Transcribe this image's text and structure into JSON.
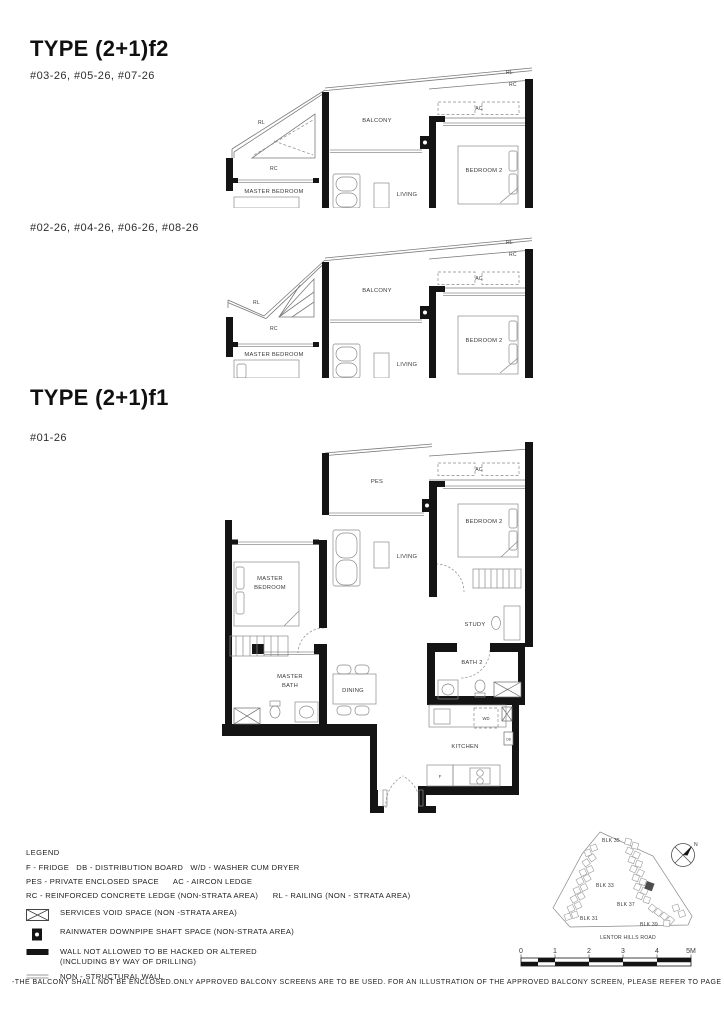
{
  "sections": {
    "f2": {
      "title": "TYPE (2+1)f2",
      "units_a": "#03-26, #05-26, #07-26",
      "units_b": "#02-26, #04-26, #06-26, #08-26"
    },
    "f1": {
      "title": "TYPE (2+1)f1",
      "units": "#01-26"
    }
  },
  "rooms": {
    "balcony": "BALCONY",
    "pes": "PES",
    "ac": "AC",
    "rl": "RL",
    "rc": "RC",
    "master_bedroom": "MASTER BEDROOM",
    "master": "MASTER",
    "bedroom": "BEDROOM",
    "bath": "BATH",
    "living": "LIVING",
    "bedroom2": "BEDROOM 2",
    "study": "STUDY",
    "bath2": "BATH 2",
    "dining": "DINING",
    "kitchen": "KITCHEN",
    "wd": "WD",
    "db": "DB",
    "f": "F"
  },
  "legend": {
    "heading": "LEGEND",
    "line1": "F - FRIDGE   DB - DISTRIBUTION BOARD   W/D - WASHER CUM DRYER",
    "line2": "PES - PRIVATE ENCLOSED SPACE      AC - AIRCON LEDGE",
    "line3": "RC - REINFORCED CONCRETE LEDGE (NON-STRATA AREA)      RL - RAILING (NON - STRATA AREA)",
    "symbols": [
      {
        "label": "SERVICES VOID SPACE (NON -STRATA AREA)"
      },
      {
        "label": "RAINWATER DOWNPIPE SHAFT SPACE (NON-STRATA AREA)"
      },
      {
        "label": "WALL NOT ALLOWED TO BE HACKED OR ALTERED",
        "label2": "(INCLUDING BY WAY OF DRILLING)"
      },
      {
        "label": "NON - STRUCTURAL WALL"
      }
    ]
  },
  "site_map": {
    "blk35": "BLK 35",
    "blk33": "BLK 33",
    "blk31": "BLK 31",
    "blk37": "BLK 37",
    "blk39": "BLK 39",
    "road": "LENTOR HILLS ROAD",
    "north": "N"
  },
  "scale": {
    "t0": "0",
    "t1": "1",
    "t2": "2",
    "t3": "3",
    "t4": "4",
    "t5": "5M"
  },
  "footer": {
    "disclaimer": "-THE BALCONY SHALL NOT BE ENCLOSED.ONLY APPROVED BALCONY SCREENS ARE TO BE USED. FOR AN ILLUSTRATION OF THE APPROVED BALCONY SCREEN, PLEASE REFER TO PAGE XXX OF THIS BROCHURE."
  },
  "colors": {
    "wall": "#141414",
    "thin_line": "#7a7a7a",
    "text": "#3a3a3a"
  }
}
